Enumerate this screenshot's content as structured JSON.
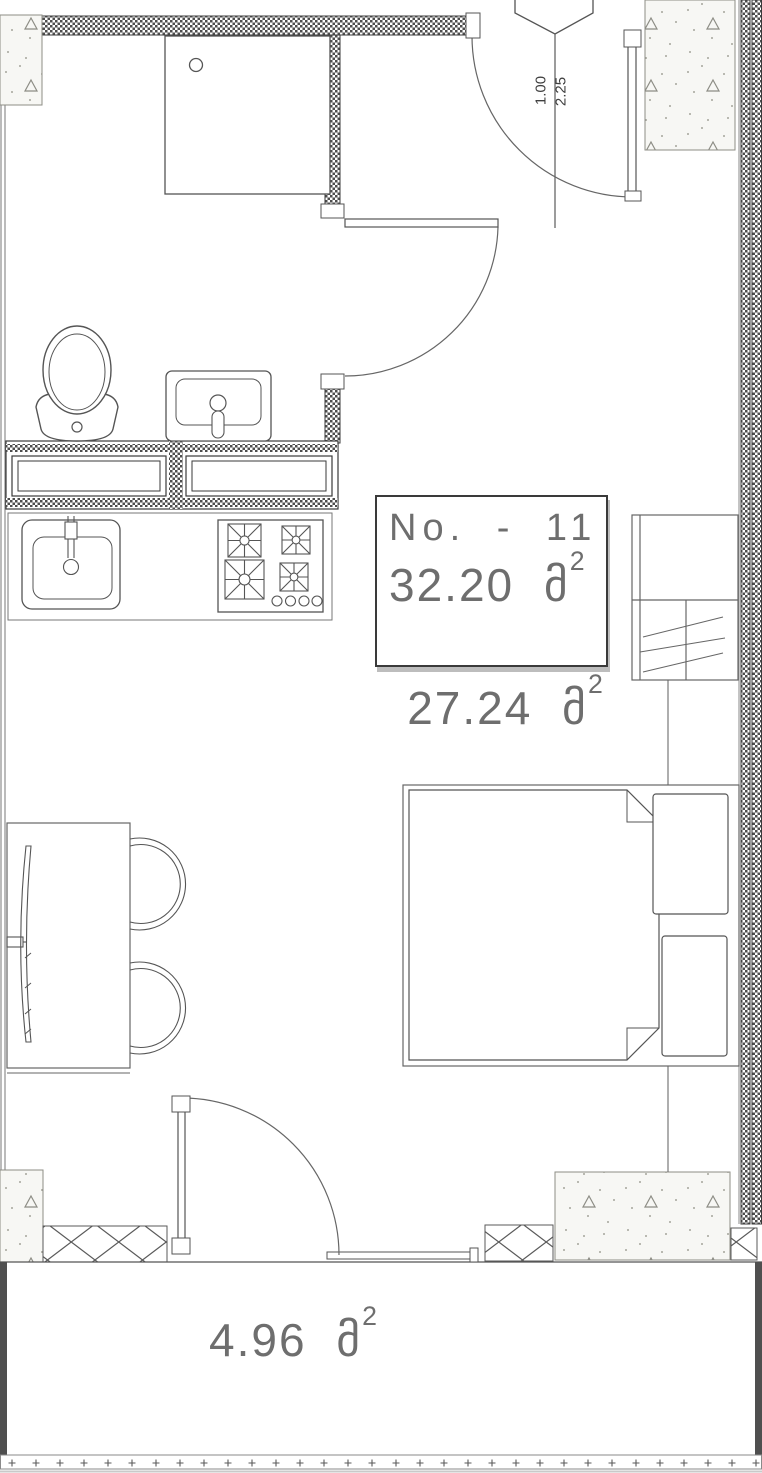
{
  "plan": {
    "unit_box": {
      "number_label": "No. - 11",
      "area_value": "32.20",
      "area_unit": "მ",
      "area_sup": "2"
    },
    "room_area": {
      "value": "27.24",
      "unit": "მ",
      "sup": "2"
    },
    "balcony_area": {
      "value": "4.96",
      "unit": "მ",
      "sup": "2"
    },
    "entrance_dimensions": {
      "width_m": "1.00",
      "height_m": "2.25"
    }
  },
  "colors": {
    "paper": "#ffffff",
    "line": "#555555",
    "wall_hatch": "#4e4e4e",
    "wall_solid": "#4f4f4f",
    "text_grey": "#6e6e6e"
  }
}
